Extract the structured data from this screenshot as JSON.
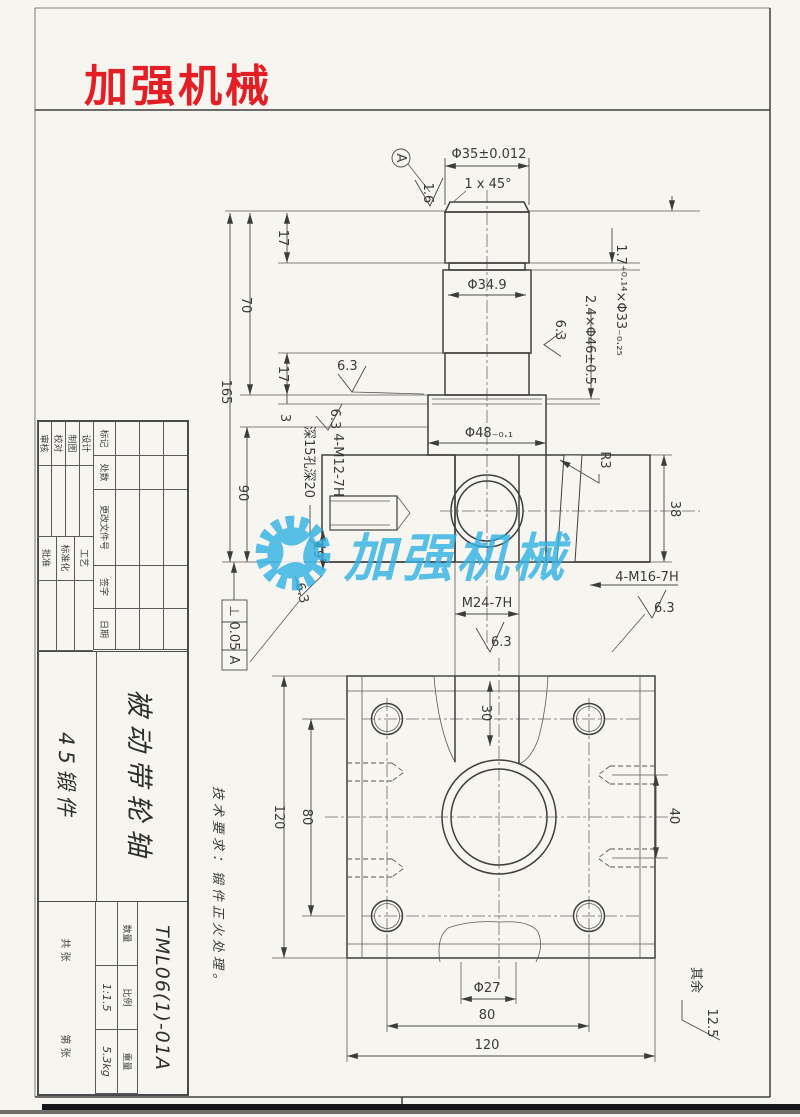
{
  "logo": {
    "text": "加强机械",
    "color": "#e31e24"
  },
  "watermark": {
    "text": "加强机械",
    "color": "#35b2e5"
  },
  "notes": {
    "tech": "技术要求：锻件正火处理。",
    "rest_label": "其余",
    "rest_value": "12.5"
  },
  "front_view": {
    "phi35": "Φ35±0.012",
    "chamfer": "1 x 45°",
    "rough_16": "1.6",
    "datum_a": "A",
    "len17_top": "17",
    "len70": "70",
    "len165": "165",
    "len17_low": "17",
    "len3": "3",
    "len90": "90",
    "len19": "19",
    "phi349": "Φ34.9",
    "groove33": "1.7⁺⁰·¹⁴×Φ33₋₀.₂₅",
    "groove46": "2.4×Φ46±0.5",
    "phi48": "Φ48₋₀.₁",
    "m12": "4-M12-7H",
    "m12_depth": "深15孔深20",
    "r3": "R3",
    "t38": "38",
    "m16": "4-M16-7H",
    "m24": "M24-7H",
    "rough_63": "6.3",
    "fcf_sym": "⊥",
    "fcf_tol": "0.05",
    "fcf_datum": "A"
  },
  "bottom_view": {
    "d30": "30",
    "d120_side": "120",
    "d80_side": "80",
    "d40": "40",
    "phi27": "Φ27",
    "d80_bottom": "80",
    "d120_bottom": "120"
  },
  "title_block": {
    "rev_header": [
      "标记",
      "处数",
      "更改文件号",
      "签字",
      "日期"
    ],
    "roles": [
      "设计",
      "制图",
      "校对",
      "审核"
    ],
    "roles2": [
      "工艺",
      "标准化",
      "批准"
    ],
    "part_name": "被动带轮轴",
    "material": "45锻件",
    "drawing_no": "TML06(1)-01A",
    "qty_label": "数量",
    "scale_label": "比例",
    "scale_value": "1:1.5",
    "weight_label": "重量",
    "weight_value": "5.3kg",
    "sheets": "共  张",
    "sheet_no": "第  张"
  }
}
